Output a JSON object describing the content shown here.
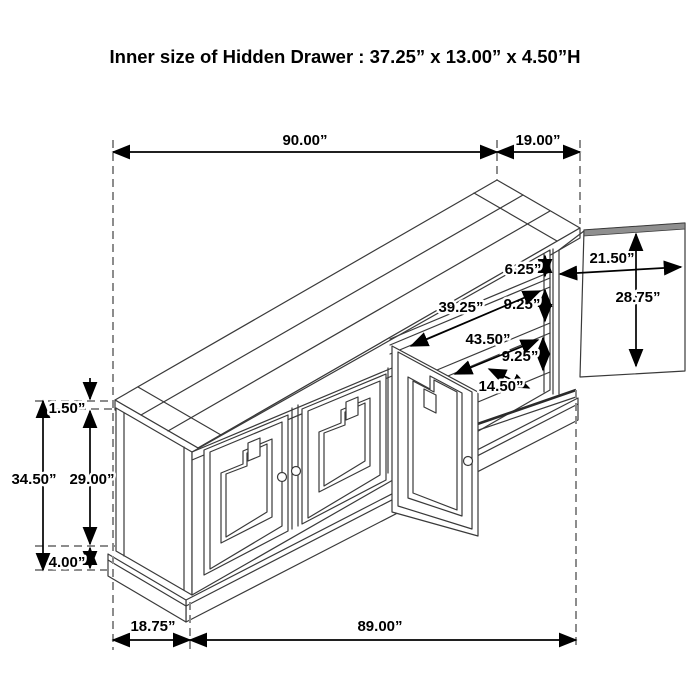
{
  "title": "Inner size of Hidden Drawer : 37.25” x 13.00” x 4.50”H",
  "subject": "sideboard cabinet dimension drawing with hidden drawer open",
  "colors": {
    "background": "#ffffff",
    "line_art": "#3a3a3a",
    "dimension_lines": "#000000",
    "extension_dashes": "#8c8c8c",
    "door_edge_band": "#8f8f8f"
  },
  "dimensions": {
    "overall_width": "90.00”",
    "open_door_extension": "19.00”",
    "overall_height": "34.50”",
    "top_thickness": "1.50”",
    "door_height": "29.00”",
    "base_height": "4.00”",
    "side_depth": "18.75”",
    "body_width": "89.00”",
    "opening_gap_top": "6.25”",
    "shelf_gap_upper": "9.25”",
    "shelf_gap_lower": "9.25”",
    "interior_width_upper": "39.25”",
    "interior_width_lower": "43.50”",
    "interior_depth": "14.50”",
    "open_door_width": "21.50”",
    "open_door_height": "28.75”"
  }
}
